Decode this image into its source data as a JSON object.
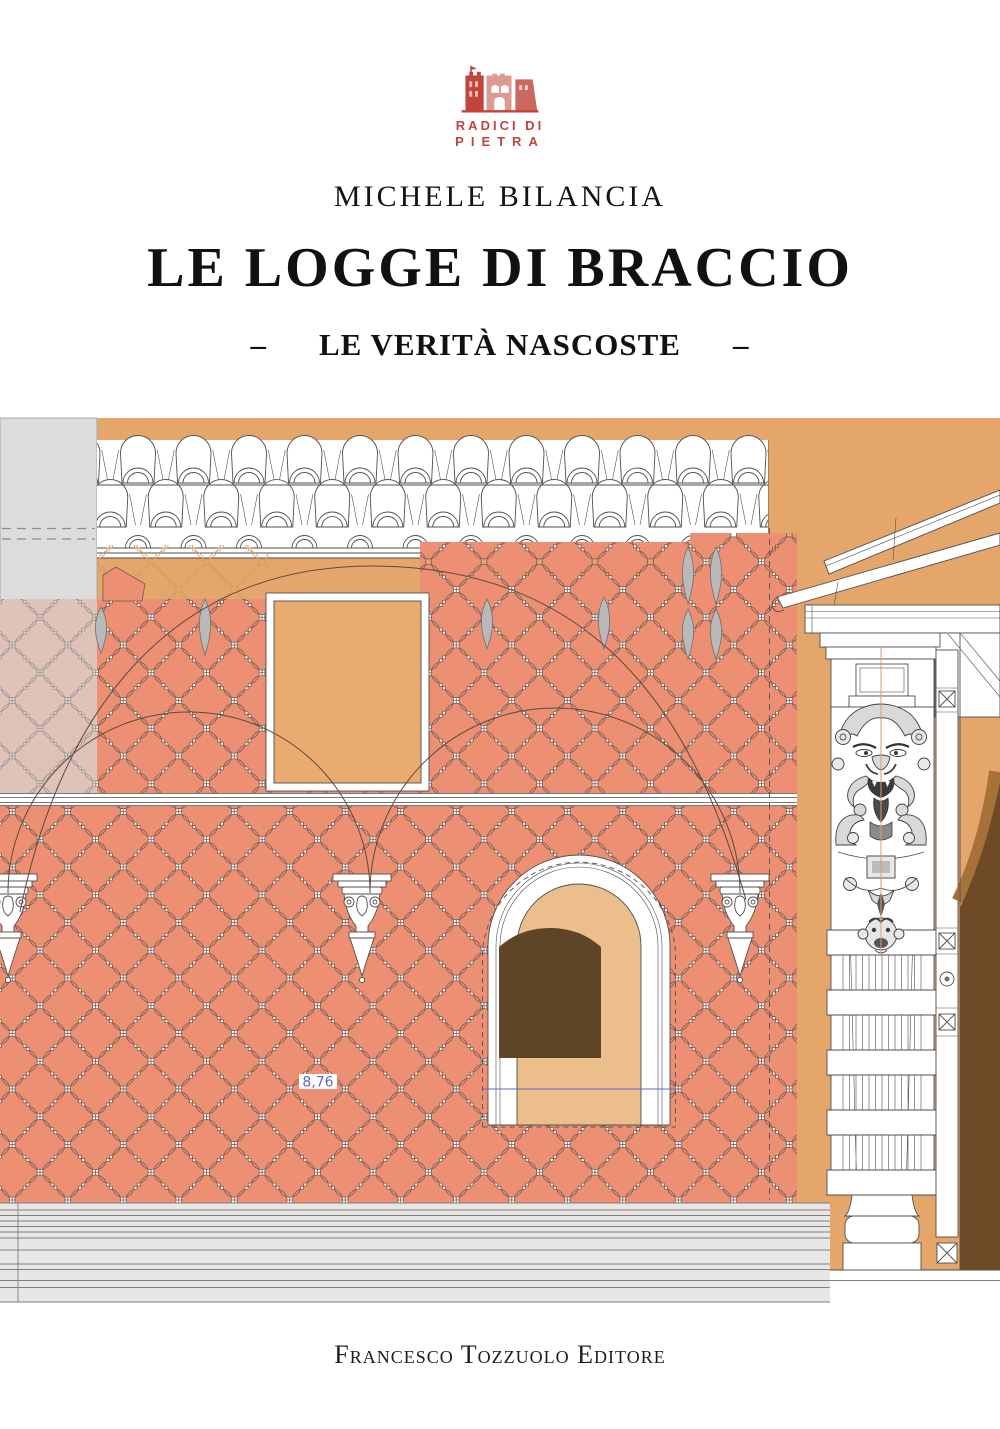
{
  "header": {
    "logo": {
      "line1": "RADICI DI",
      "line2": "PIETRA"
    },
    "author": "MICHELE BILANCIA",
    "title": "LE LOGGE DI BRACCIO",
    "subtitle": {
      "dash": "–",
      "text": "LE VERITÀ NASCOSTE"
    }
  },
  "footer": {
    "publisher": "Francesco Tozzuolo Editore"
  },
  "drawing": {
    "dimension_label": "8,76",
    "colors": {
      "logo_red": "#c2453c",
      "logo_pink": "#db9b93",
      "logo_mid": "#ca6a5e",
      "wall_orange": "#e5a66b",
      "pattern_salmon": "#ec8f72",
      "pattern_outline": "#6e5b54",
      "muted_motif": "#dfc3b8",
      "muted_bg": "#dbdada",
      "panel_gray": "#dcdcdc",
      "reveal_tan": "#ecbe8c",
      "window_brown": "#5e4527",
      "portal_mid": "#a8713a",
      "portal_dark": "#6f4a26",
      "teardrop_gray": "#b9b9b9",
      "steps_bg": "#e9e7e5",
      "dim_blue": "#5b6bc0",
      "ghost_line": "#cf9a66",
      "axis_orange": "#e39a6a",
      "line_dark": "#4f4f4f",
      "arc_line": "#5c4a40"
    }
  }
}
